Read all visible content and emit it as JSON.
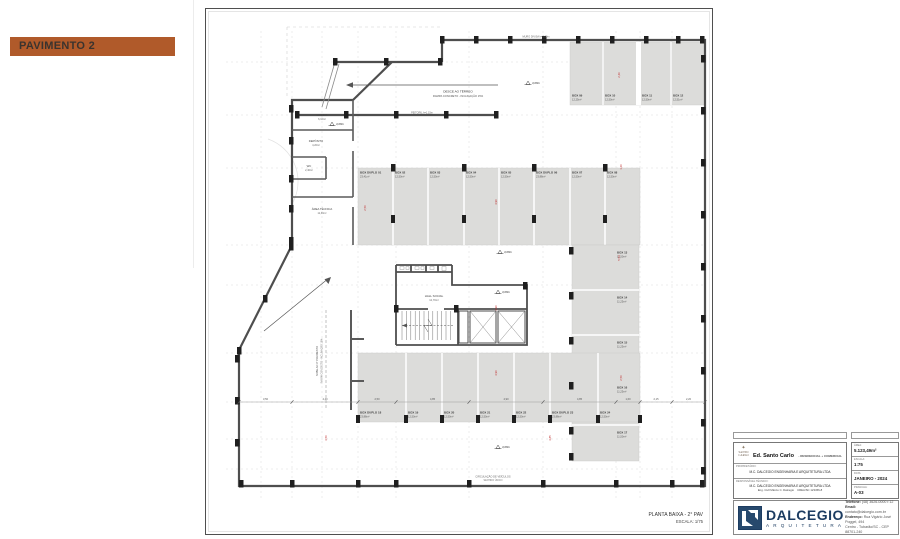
{
  "banner": {
    "label": "PAVIMENTO 2"
  },
  "colors": {
    "banner_bg": "#b05a2a",
    "logo_navy": "#1c3c61",
    "plan_gray": "#dcdcda",
    "dim_red": "#c03030"
  },
  "sheet": {
    "plan_title": "PLANTA BAIXA - 2° PAV",
    "plan_scale": "ESCALA: 1/75",
    "ramp_note_line1": "DESCE AO TÉRREO",
    "ramp_note_line2": "RAMPA CONCRETO - INCLINAÇÃO 15%",
    "ramp2_line1": "SOBE AO 3° PAVIMENTO",
    "ramp2_line2": "RAMPA CONCRETO - INCLINAÇÃO 15%",
    "wall_note": "PEITORIL h=1,15m",
    "muro_note": "MURO DIVISA h=2,00m",
    "aisle_note_line1": "CIRCULAÇÃO DE VEÍCULOS",
    "aisle_note_line2": "SENTIDO ÚNICO",
    "level_value": "3,08m",
    "core": {
      "hall_name": "HALL SOCIAL",
      "hall_area": "12,70m²"
    },
    "rooms": [
      {
        "name": "LIXEIRA",
        "area": "6,10m²"
      },
      {
        "name": "DEPÓSITO",
        "area": "4,20m²"
      },
      {
        "name": "WC",
        "area": "2,40m²"
      },
      {
        "name": "ÁREA TÉCNICA",
        "area": "11,30m²"
      }
    ],
    "parking": {
      "upper_row": [
        {
          "name": "BOX DUPLO 01",
          "area": "23,41m²"
        },
        {
          "name": "BOX 02",
          "area": "12,50m²"
        },
        {
          "name": "BOX 03",
          "area": "12,50m²"
        },
        {
          "name": "BOX 04",
          "area": "12,50m²"
        },
        {
          "name": "BOX 05",
          "area": "12,50m²"
        },
        {
          "name": "BOX DUPLO 06",
          "area": "23,88m²"
        },
        {
          "name": "BOX 07",
          "area": "12,50m²"
        },
        {
          "name": "BOX 08",
          "area": "12,50m²"
        }
      ],
      "top_right_row": [
        {
          "name": "BOX 09",
          "area": "12,25m²"
        },
        {
          "name": "BOX 10",
          "area": "12,50m²"
        },
        {
          "name": "BOX 11",
          "area": "12,50m²"
        },
        {
          "name": "BOX 12",
          "area": "12,51m²"
        }
      ],
      "right_column": [
        {
          "name": "BOX 13",
          "area": "11,50m²"
        },
        {
          "name": "BOX 14",
          "area": "11,25m²"
        },
        {
          "name": "BOX 15",
          "area": "11,25m²"
        },
        {
          "name": "BOX 16",
          "area": "11,25m²"
        },
        {
          "name": "BOX 17",
          "area": "11,50m²"
        }
      ],
      "bottom_row": [
        {
          "name": "BOX DUPLO 18",
          "area": "23,88m²"
        },
        {
          "name": "BOX 19",
          "area": "12,50m²"
        },
        {
          "name": "BOX 20",
          "area": "12,50m²"
        },
        {
          "name": "BOX 21",
          "area": "12,50m²"
        },
        {
          "name": "BOX 22",
          "area": "12,50m²"
        },
        {
          "name": "BOX DUPLO 23",
          "area": "23,88m²"
        },
        {
          "name": "BOX 24",
          "area": "12,50m²"
        }
      ]
    },
    "red_dims": [
      "2,46",
      "4,90",
      "2,50",
      "1,20",
      "4,90",
      "5,54",
      "4,90",
      "2,50",
      "3,50",
      "4,85"
    ],
    "dim_row": [
      "3,50",
      "4,40",
      "2,50",
      "4,85",
      "4,90",
      "4,85",
      "1,60",
      "2,15",
      "2,20"
    ]
  },
  "titleblock": {
    "crest_line1": "SANTO",
    "crest_line2": "CARLO",
    "title_bold": "Ed. Santo Carlo",
    "title_suffix": "- RESIDENCIAL + COMERCIAL",
    "address_line1": "Rua José Bonifácio, LOTES 05, 06 E 07, esquina c/ Avenida",
    "address_line2": "Tubarão - SC",
    "owner_label": "PROPRIETÁRIO:",
    "owner_value": "M.C. DALCEGIO ENGENHARIA E ARQUITETURA LTDA",
    "resp_label": "RESPONSÁVEL TÉCNICO:",
    "resp_value1": "M.C. DALCEGIO ENGENHARIA E ARQUITETURA LTDA",
    "resp_value2": "Eng. Civil Márcio C. Dalcegio",
    "resp_value3": "CREA/SC 123456-8",
    "area_label": "ÁREA:",
    "area_value": "5.123,49m²",
    "escala_label": "ESCALA:",
    "escala_value": "1:75",
    "data_label": "DATA:",
    "data_value": "JANEIRO - 2024",
    "prancha_label": "PRANCHA:",
    "prancha_value": "A-03"
  },
  "logoblock": {
    "name": "DALCEGIO",
    "subtitle": "ARQUITETURA",
    "contact1_label": "Telefone:",
    "contact1_value": "(48) 3626-0000 r.12",
    "contact2_label": "Email:",
    "contact2_value": "contato@dalcegio.com.br",
    "contact3_label": "Endereço:",
    "contact3_value": "Rua Vigário José Poggel, 494",
    "contact4_value": "Centro - Tubarão/SC - CEP 88701-240"
  }
}
